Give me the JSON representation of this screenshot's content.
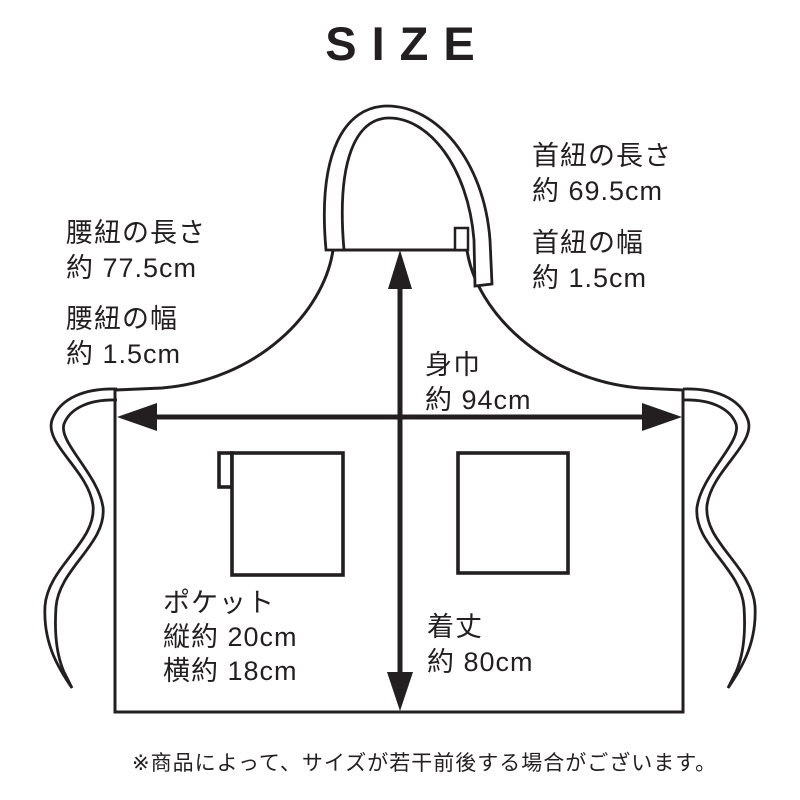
{
  "title": "SIZE",
  "colors": {
    "ink": "#231f20",
    "background": "#ffffff"
  },
  "apron": {
    "labels": {
      "neck_length": {
        "name": "首紐の長さ",
        "value": "約 69.5cm"
      },
      "neck_width": {
        "name": "首紐の幅",
        "value": "約 1.5cm"
      },
      "waist_length": {
        "name": "腰紐の長さ",
        "value": "約 77.5cm"
      },
      "waist_width": {
        "name": "腰紐の幅",
        "value": "約 1.5cm"
      },
      "body_width": {
        "name": "身巾",
        "value": "約 94cm"
      },
      "garment_length": {
        "name": "着丈",
        "value": "約 80cm"
      },
      "pocket": {
        "name": "ポケット",
        "height": "縦約 20cm",
        "width": "横約 18cm"
      }
    }
  },
  "footnote": "※商品によって、サイズが若干前後する場合がございます。"
}
